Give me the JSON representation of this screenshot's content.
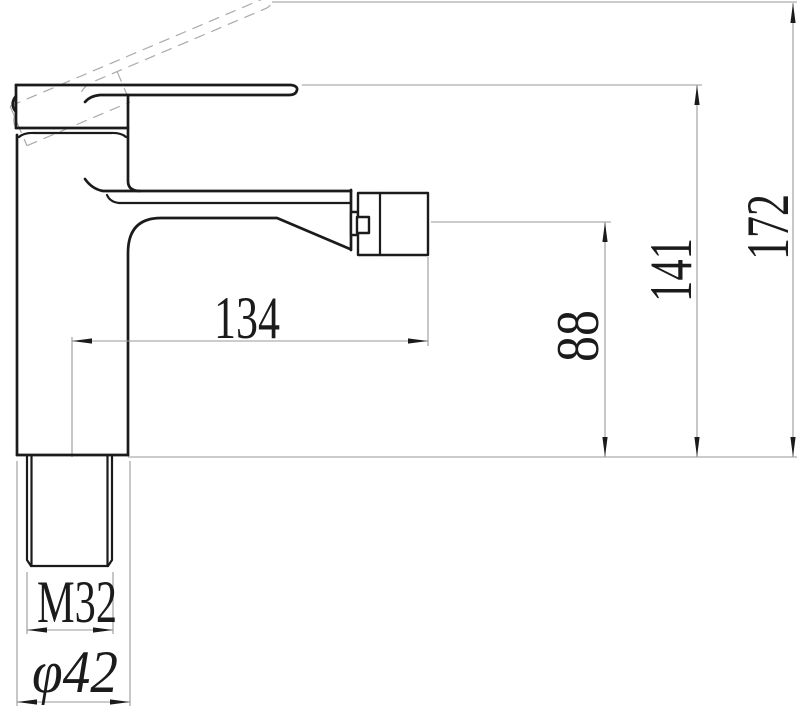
{
  "figure": {
    "type": "technical-drawing-faucet-side-view",
    "colors": {
      "background": "#ffffff",
      "line": "#1b1b1b",
      "thin_line": "#999999",
      "dashed_line": "#aaaaaa"
    },
    "dimensions": {
      "spout_reach": "134",
      "spout_outlet_height": "88",
      "lever_top_height": "141",
      "total_height_lever_raised": "172",
      "inlet_thread": "M32",
      "base_diameter": "φ42"
    }
  }
}
